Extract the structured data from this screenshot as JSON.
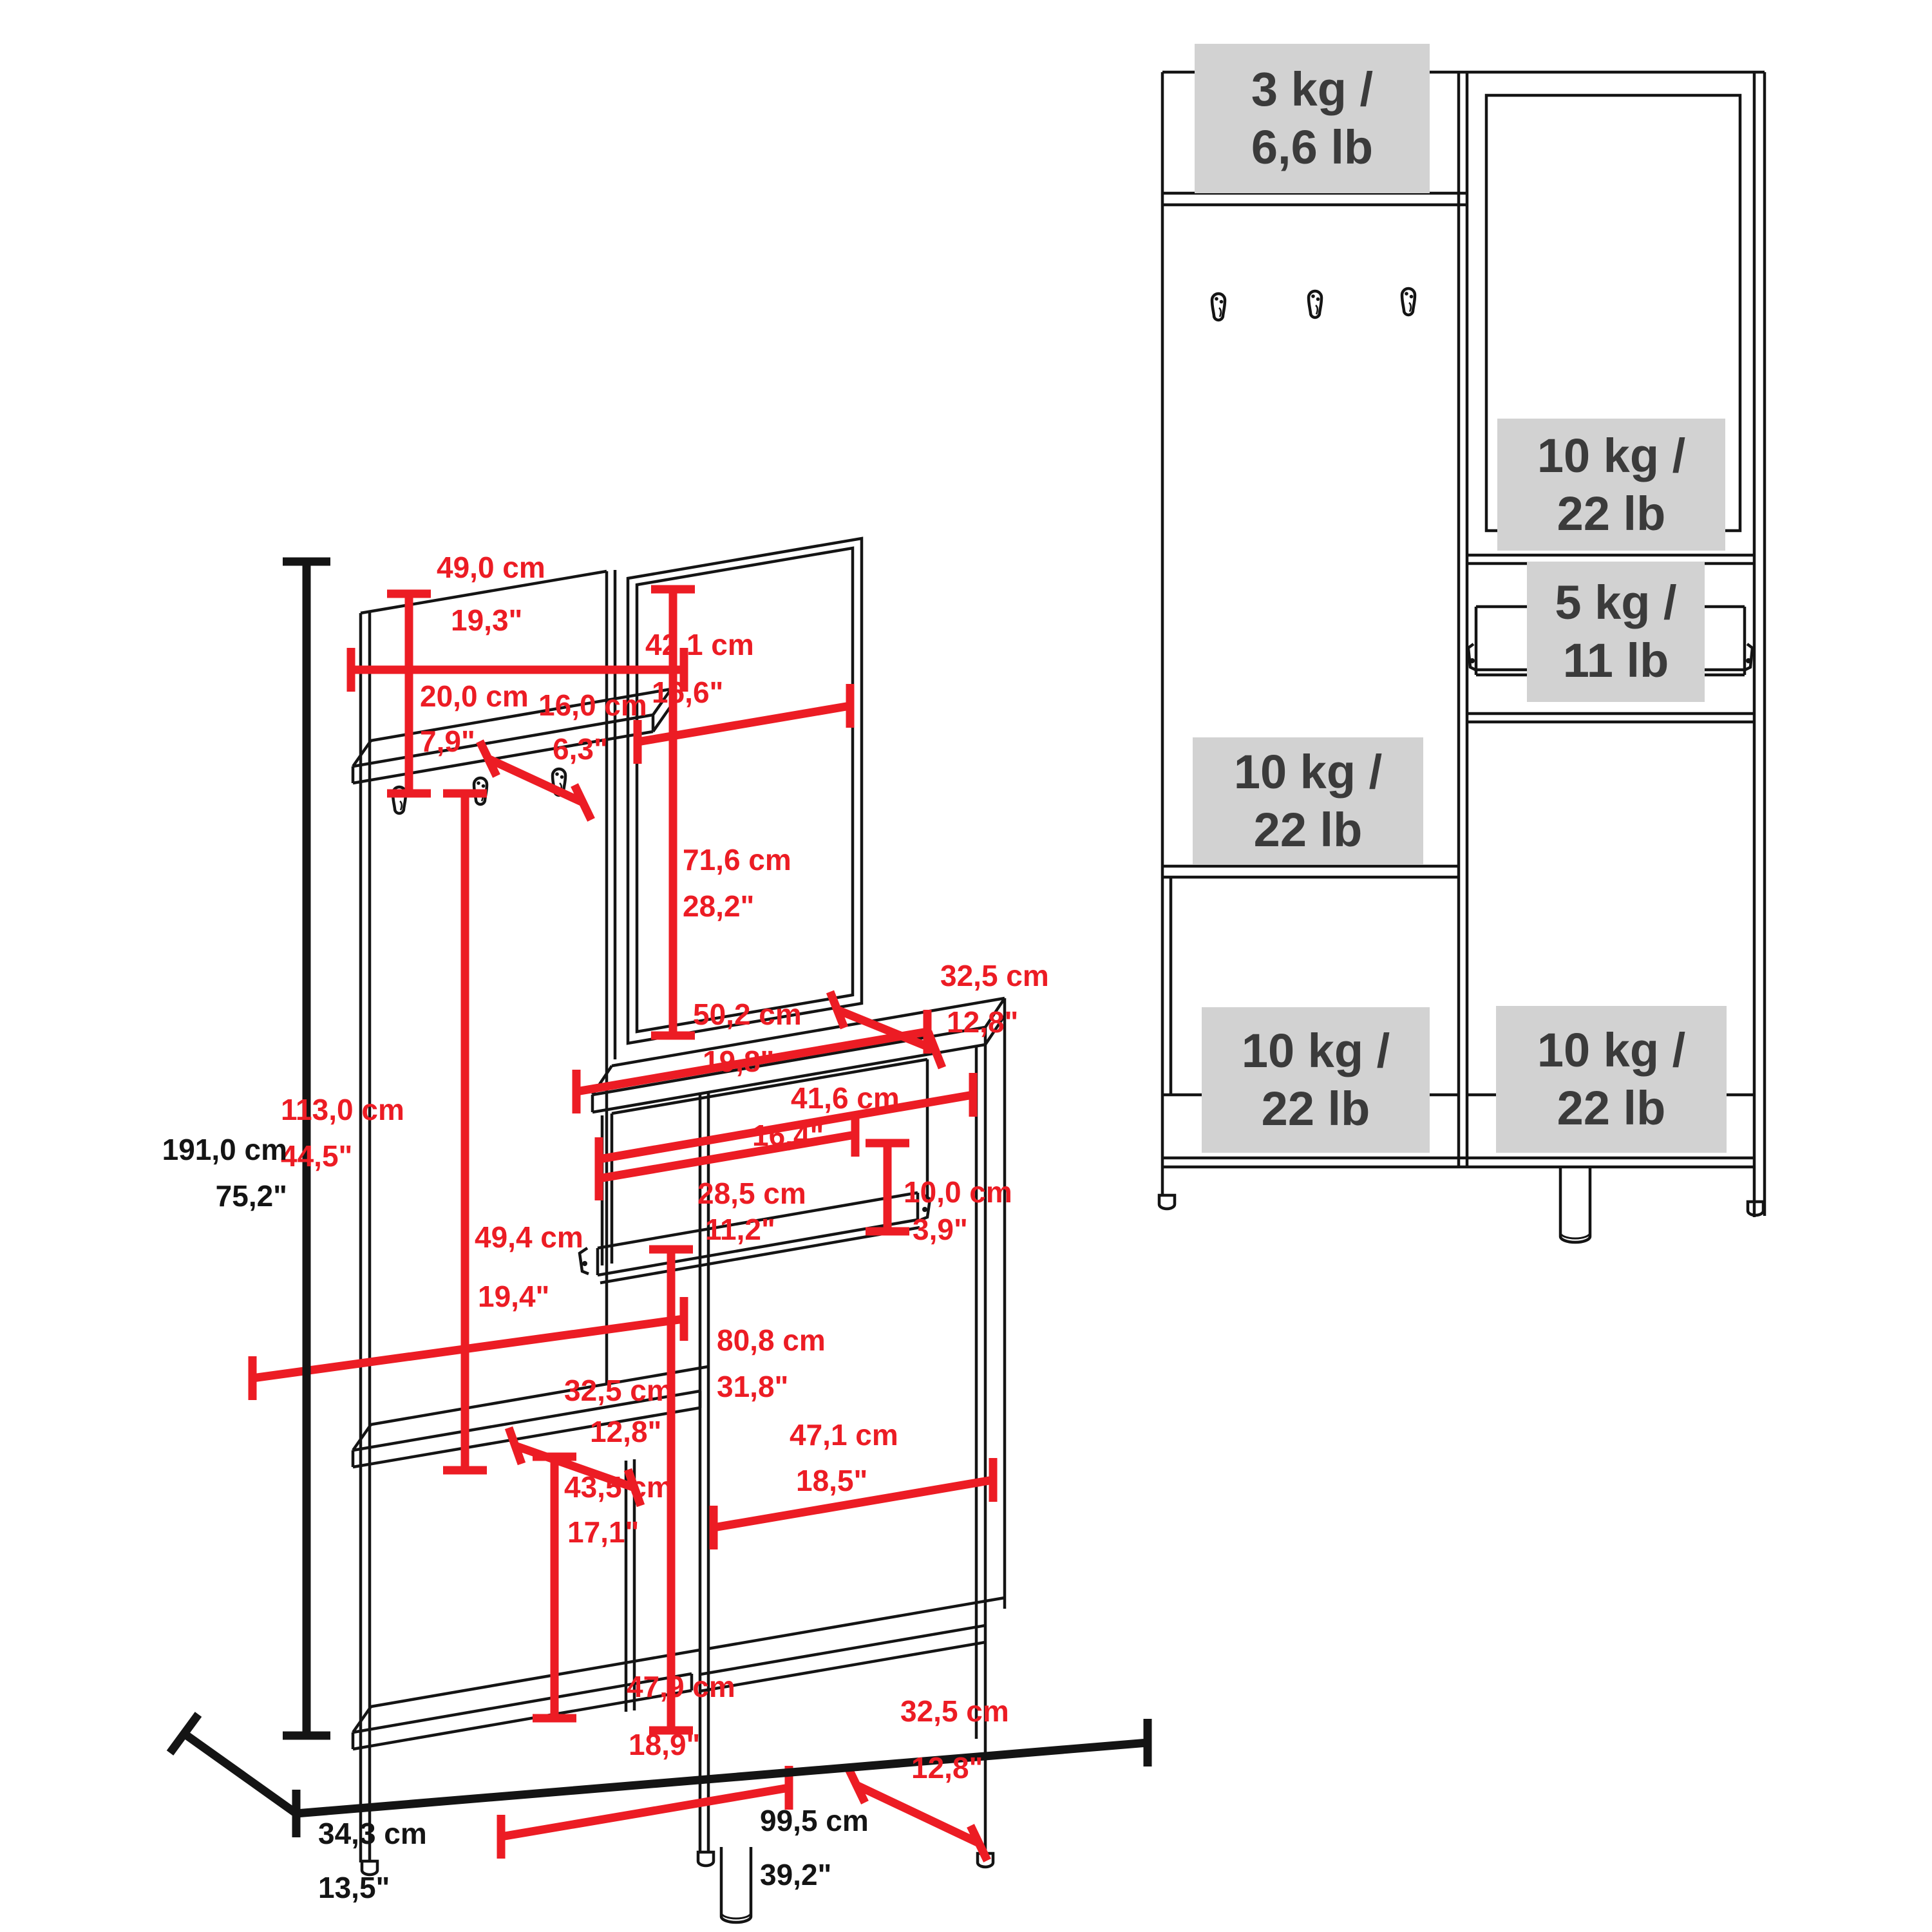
{
  "colors": {
    "background": "#FFFFFF",
    "line_black": "#141414",
    "dimension_red": "#EC1C24",
    "capacity_box_bg": "#D2D2D2",
    "capacity_text": "#3B3B3B"
  },
  "left_view": {
    "height": {
      "cm": "191,0 cm",
      "in": "75,2\""
    },
    "depth": {
      "cm": "34,3 cm",
      "in": "13,5\""
    },
    "width": {
      "cm": "99,5 cm",
      "in": "39,2\""
    },
    "dims": [
      {
        "id": "shelf-width",
        "cm": "49,0 cm",
        "in": "19,3\""
      },
      {
        "id": "shelf-drop",
        "cm": "20,0 cm",
        "in": "7,9\""
      },
      {
        "id": "shelf-depth",
        "cm": "16,0 cm",
        "in": "6,3\""
      },
      {
        "id": "mirror-width",
        "cm": "42,1 cm",
        "in": "16,6\""
      },
      {
        "id": "mirror-height",
        "cm": "71,6 cm",
        "in": "28,2\""
      },
      {
        "id": "panel-height",
        "cm": "113,0 cm",
        "in": "44,5\""
      },
      {
        "id": "left-inner-width",
        "cm": "49,4 cm",
        "in": "19,4\""
      },
      {
        "id": "bench-depth",
        "cm": "32,5 cm",
        "in": "12,8\""
      },
      {
        "id": "bench-height",
        "cm": "43,5 cm",
        "in": "17,1\""
      },
      {
        "id": "cabinet-top-width",
        "cm": "50,2 cm",
        "in": "19,8\""
      },
      {
        "id": "cabinet-top-depth",
        "cm": "32,5 cm",
        "in": "12,8\""
      },
      {
        "id": "drawer-opening-width",
        "cm": "41,6 cm",
        "in": "16,4\""
      },
      {
        "id": "drawer-width",
        "cm": "28,5 cm",
        "in": "11,2\""
      },
      {
        "id": "drawer-height",
        "cm": "10,0 cm",
        "in": "3,9\""
      },
      {
        "id": "lower-cavity-height",
        "cm": "80,8 cm",
        "in": "31,8\""
      },
      {
        "id": "lower-right-width",
        "cm": "47,1 cm",
        "in": "18,5\""
      },
      {
        "id": "lower-left-width",
        "cm": "47,9 cm",
        "in": "18,9\""
      },
      {
        "id": "bottom-depth",
        "cm": "32,5 cm",
        "in": "12,8\""
      }
    ]
  },
  "right_view": {
    "capacities": [
      {
        "id": "top-shelf",
        "kg": "3 kg /",
        "lb": "6,6 lb"
      },
      {
        "id": "mirror-door",
        "kg": "10 kg /",
        "lb": "22 lb"
      },
      {
        "id": "drawer",
        "kg": "5 kg /",
        "lb": "11 lb"
      },
      {
        "id": "middle-left",
        "kg": "10 kg /",
        "lb": "22 lb"
      },
      {
        "id": "bottom-left",
        "kg": "10 kg /",
        "lb": "22 lb"
      },
      {
        "id": "bottom-right",
        "kg": "10 kg /",
        "lb": "22 lb"
      }
    ]
  }
}
